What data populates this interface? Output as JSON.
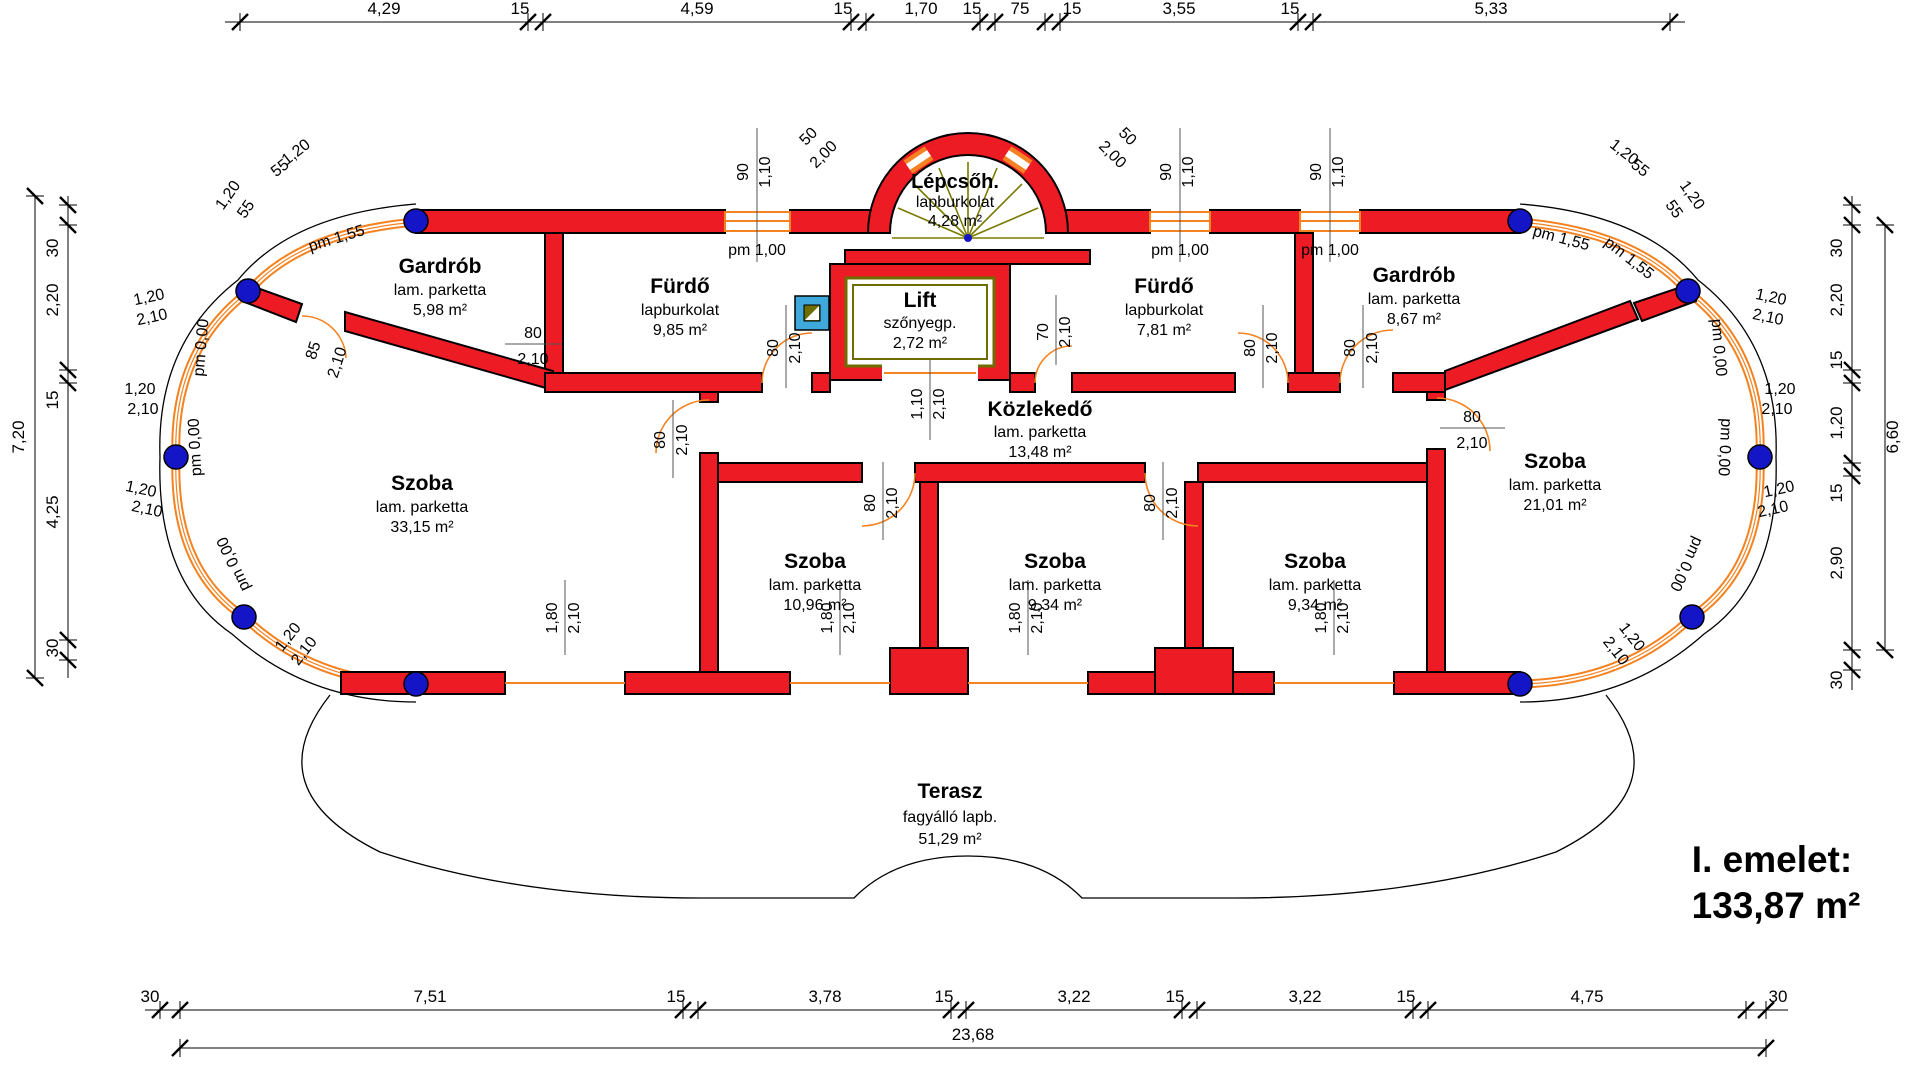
{
  "plan": {
    "title_line1": "I. emelet:",
    "title_line2": "133,87 m²",
    "rooms": {
      "gardrob_l": {
        "name": "Gardrób",
        "finish": "lam. parketta",
        "area": "5,98 m²"
      },
      "furdo_l": {
        "name": "Fürdő",
        "finish": "lapburkolat",
        "area": "9,85 m²"
      },
      "lepcso": {
        "name": "Lépcsőh.",
        "finish": "lapburkolat",
        "area": "4,28 m²"
      },
      "lift": {
        "name": "Lift",
        "finish": "szőnyegp.",
        "area": "2,72 m²"
      },
      "furdo_r": {
        "name": "Fürdő",
        "finish": "lapburkolat",
        "area": "7,81 m²"
      },
      "gardrob_r": {
        "name": "Gardrób",
        "finish": "lam. parketta",
        "area": "8,67 m²"
      },
      "szoba_l": {
        "name": "Szoba",
        "finish": "lam. parketta",
        "area": "33,15 m²"
      },
      "kozlekedo": {
        "name": "Közlekedő",
        "finish": "lam. parketta",
        "area": "13,48 m²"
      },
      "szoba_1": {
        "name": "Szoba",
        "finish": "lam. parketta",
        "area": "10,96 m²"
      },
      "szoba_2": {
        "name": "Szoba",
        "finish": "lam. parketta",
        "area": "9,34 m²"
      },
      "szoba_3": {
        "name": "Szoba",
        "finish": "lam. parketta",
        "area": "9,34 m²"
      },
      "szoba_r": {
        "name": "Szoba",
        "finish": "lam. parketta",
        "area": "21,01 m²"
      },
      "terasz": {
        "name": "Terasz",
        "finish": "fagyálló lapb.",
        "area": "51,29 m²"
      }
    },
    "dims": {
      "top": [
        "4,29",
        "15",
        "4,59",
        "15",
        "1,70",
        "15",
        "75",
        "15",
        "3,55",
        "15",
        "5,33"
      ],
      "bottom": [
        "30",
        "7,51",
        "15",
        "3,78",
        "15",
        "3,22",
        "15",
        "3,22",
        "15",
        "4,75",
        "30"
      ],
      "bottom_total": "23,68",
      "left": [
        "30",
        "2,20",
        "15",
        "4,25",
        "30"
      ],
      "left_total": "7,20",
      "right": [
        "30",
        "2,20",
        "15",
        "1,20",
        "15",
        "2,90",
        "30"
      ],
      "right_total": "6,60"
    },
    "labels": {
      "d50": "50",
      "d200": "2,00",
      "d90": "90",
      "d110": "1,10",
      "d210": "2,10",
      "d80": "80",
      "d70": "70",
      "d85": "85",
      "d180": "1,80",
      "d120": "1,20",
      "d55": "55",
      "pm100": "pm 1,00",
      "pm000": "pm 0,00",
      "pm155": "pm 1,55"
    },
    "colors": {
      "wall": "#ED1C24",
      "glass": "#F58220",
      "column": "#1515c8",
      "lift_frame": "#6d6d00",
      "symbol_box": "#3FA9DC"
    }
  }
}
